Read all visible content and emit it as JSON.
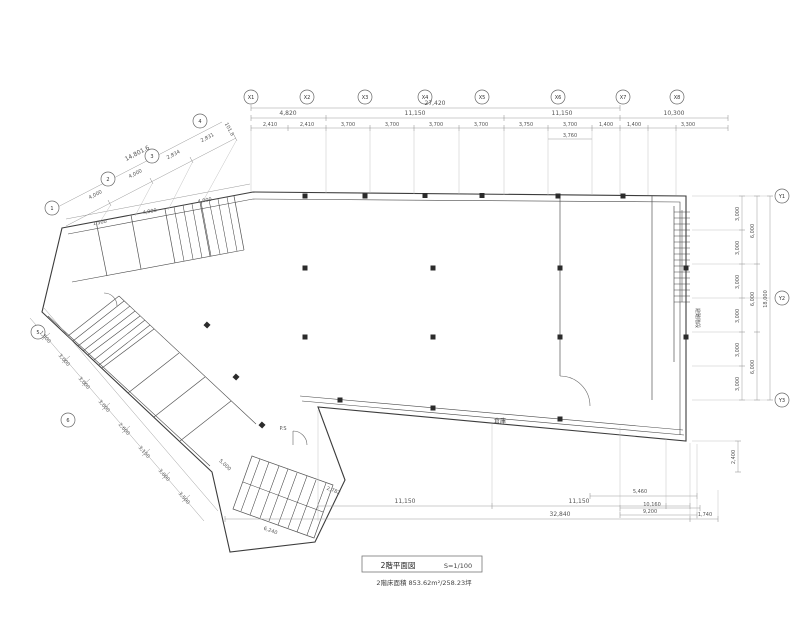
{
  "title_block": {
    "title": "2階平面図",
    "scale": "S=1/100",
    "area_note": "2階床面積 853.62m²/258.23坪"
  },
  "plan": {
    "room_labels": {
      "strip": "倉庫",
      "stair_right": "避難階段",
      "ps": "P.S"
    },
    "grid": {
      "top": [
        "X1",
        "X2",
        "X3",
        "X4",
        "X5",
        "X6",
        "X7",
        "X8"
      ],
      "right": [
        "Y1",
        "Y2",
        "Y3"
      ],
      "wing": [
        "1",
        "2",
        "3",
        "4",
        "5",
        "6"
      ]
    },
    "dims": {
      "top_total": "27,420",
      "top_mid": [
        "4,820",
        "11,150",
        "11,150",
        "10,300"
      ],
      "top_small": [
        "2,410",
        "2,410",
        "3,700",
        "3,700",
        "3,700",
        "3,700",
        "3,750",
        "3,700",
        "1,400",
        "1,400",
        "3,300"
      ],
      "top_sub": "3,760",
      "wing_total": "14,801.6",
      "wing_seg": [
        "4,000",
        "4,000",
        "2,834",
        "2,831"
      ],
      "wing_end": "101.8",
      "wing_inner": [
        "1,500",
        "4,000",
        "4,000"
      ],
      "left_small": [
        "1,500",
        "3,000",
        "3,000",
        "3,000",
        "2,600",
        "3,150",
        "3,000",
        "3,500"
      ],
      "right_small": [
        "3,000",
        "3,000",
        "3,000",
        "3,000",
        "3,000",
        "3,000"
      ],
      "right_mid": [
        "6,000",
        "6,000",
        "6,000"
      ],
      "right_total": "18,000",
      "right_bottom": "2,400",
      "bottom_mid": [
        "11,150",
        "11,150"
      ],
      "bottom_total": "32,840",
      "bottom_right": [
        "5,460",
        "10,160",
        "9,200"
      ],
      "bottom_right_end": "1,740",
      "entrance": [
        "2,782",
        "6,240",
        "5,000"
      ]
    }
  }
}
